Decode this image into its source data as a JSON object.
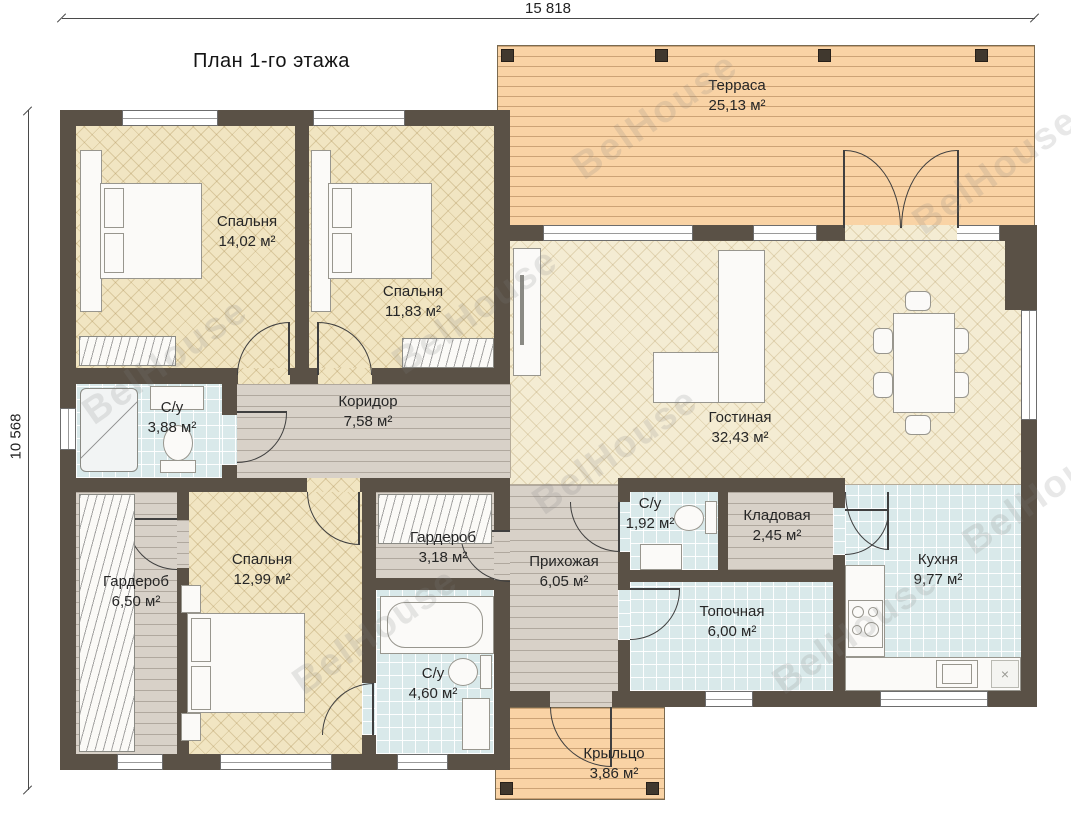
{
  "title": "План 1-го этажа",
  "watermark_text": "BelHouse",
  "dimensions": {
    "top": "15 818",
    "left": "10 568"
  },
  "icons": {
    "dishwasher_marker": "×"
  },
  "rooms": [
    {
      "id": "terrace",
      "name": "Терраса",
      "area": "25,13 м²"
    },
    {
      "id": "bedroom-1",
      "name": "Спальня",
      "area": "14,02 м²"
    },
    {
      "id": "bedroom-2",
      "name": "Спальня",
      "area": "11,83 м²"
    },
    {
      "id": "bathroom-1",
      "name": "С/у",
      "area": "3,88 м²"
    },
    {
      "id": "corridor",
      "name": "Коридор",
      "area": "7,58 м²"
    },
    {
      "id": "living-room",
      "name": "Гостиная",
      "area": "32,43 м²"
    },
    {
      "id": "wardrobe-1",
      "name": "Гардероб",
      "area": "6,50 м²"
    },
    {
      "id": "bedroom-3",
      "name": "Спальня",
      "area": "12,99 м²"
    },
    {
      "id": "wardrobe-2",
      "name": "Гардероб",
      "area": "3,18 м²"
    },
    {
      "id": "hallway",
      "name": "Прихожая",
      "area": "6,05 м²"
    },
    {
      "id": "bathroom-2",
      "name": "С/у",
      "area": "1,92 м²"
    },
    {
      "id": "storage",
      "name": "Кладовая",
      "area": "2,45 м²"
    },
    {
      "id": "boiler-room",
      "name": "Топочная",
      "area": "6,00 м²"
    },
    {
      "id": "kitchen",
      "name": "Кухня",
      "area": "9,77 м²"
    },
    {
      "id": "bathroom-3",
      "name": "С/у",
      "area": "4,60 м²"
    },
    {
      "id": "porch",
      "name": "Крыльцо",
      "area": "3,86 м²"
    }
  ]
}
